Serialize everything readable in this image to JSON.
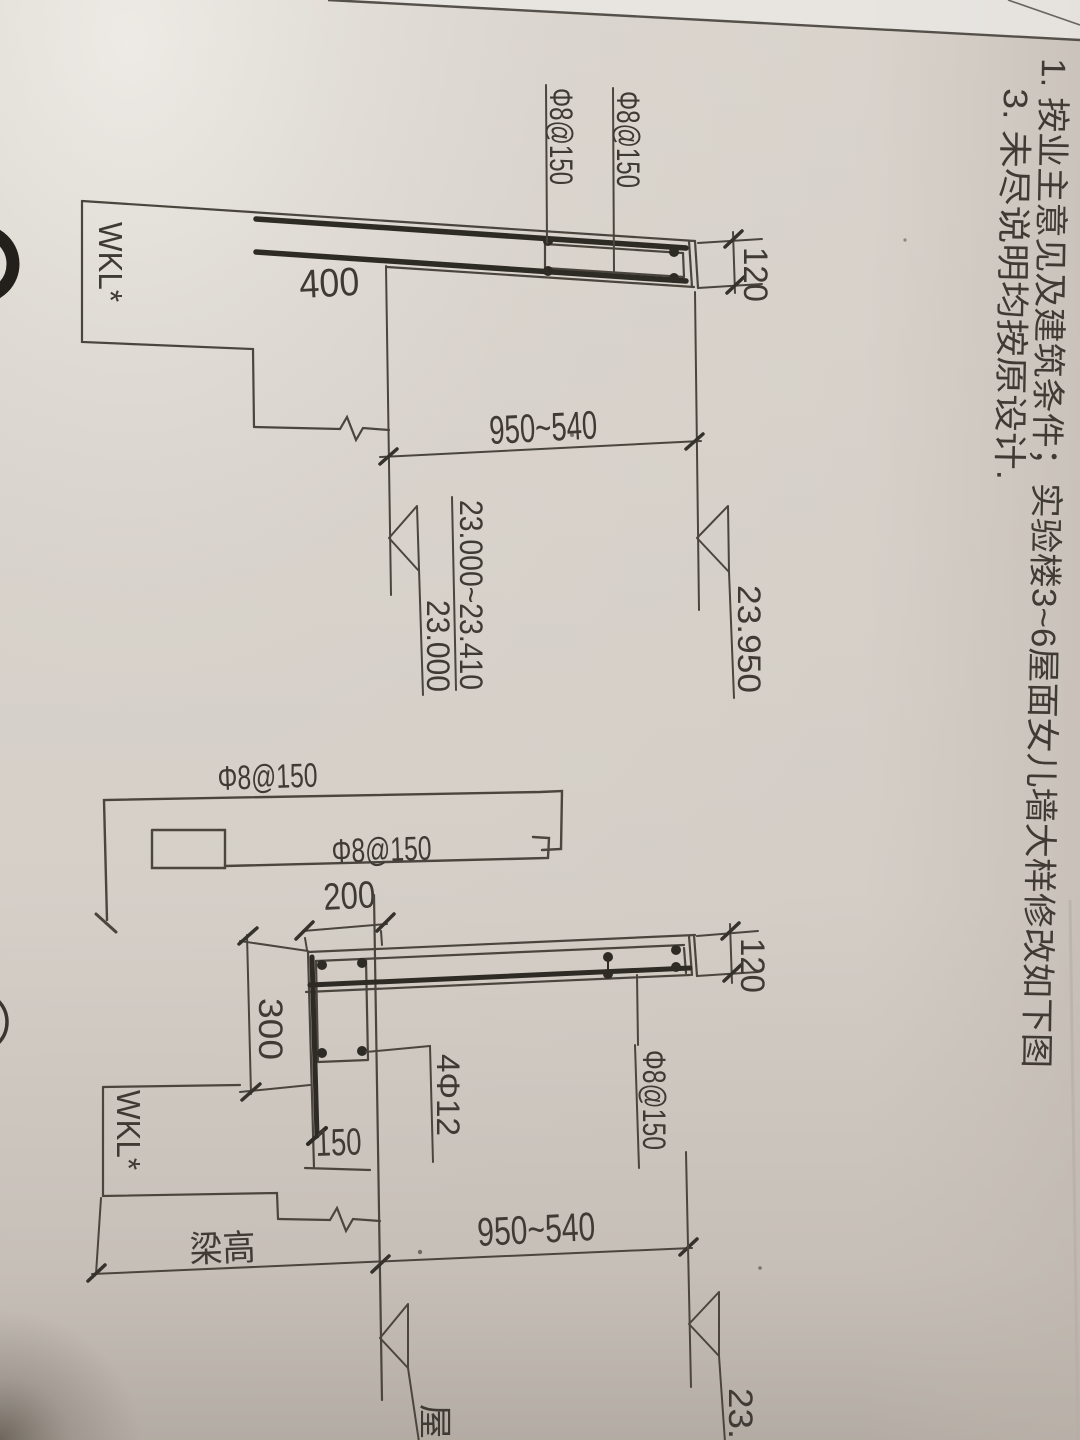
{
  "notes": {
    "note_1": "1. 按业主意见及建筑条件；实验楼3~6屋面女儿墙大样修改如下图",
    "note_3": "3. 未尽说明均按原设计."
  },
  "detail_upper": {
    "beam_label": "WKL*",
    "top_bar_label": "Φ8@150",
    "inner_bar_label": "Φ8@150",
    "anchor_length": "400",
    "wall_thickness": "120",
    "height_range": "950~540",
    "elevation_right": "23.950",
    "elevation_left_line1": "23.000~23.410",
    "elevation_left_line2": "23.000"
  },
  "detail_lower": {
    "bar_shape1_label": "Φ8@150",
    "bar_shape2_label": "Φ8@150",
    "hook_width": "200",
    "embed_depth": "300",
    "beam_label": "WKL*",
    "toe_length": "150",
    "corner_bars_label": "4Φ12",
    "wall_bar_label": "Φ8@150",
    "wall_thickness": "120",
    "beam_height_label": "梁高",
    "height_range": "950~540",
    "elevation_right_partial": "23.95",
    "roof_label_partial": "屋面"
  },
  "colors": {
    "paper": "#d8d2cb",
    "paper_light": "#ece9e4",
    "paper_dark": "#b3aca4",
    "ink_line": "#4a453d",
    "ink_heavy": "#2e2a24",
    "ink_text": "#3f3a33"
  }
}
